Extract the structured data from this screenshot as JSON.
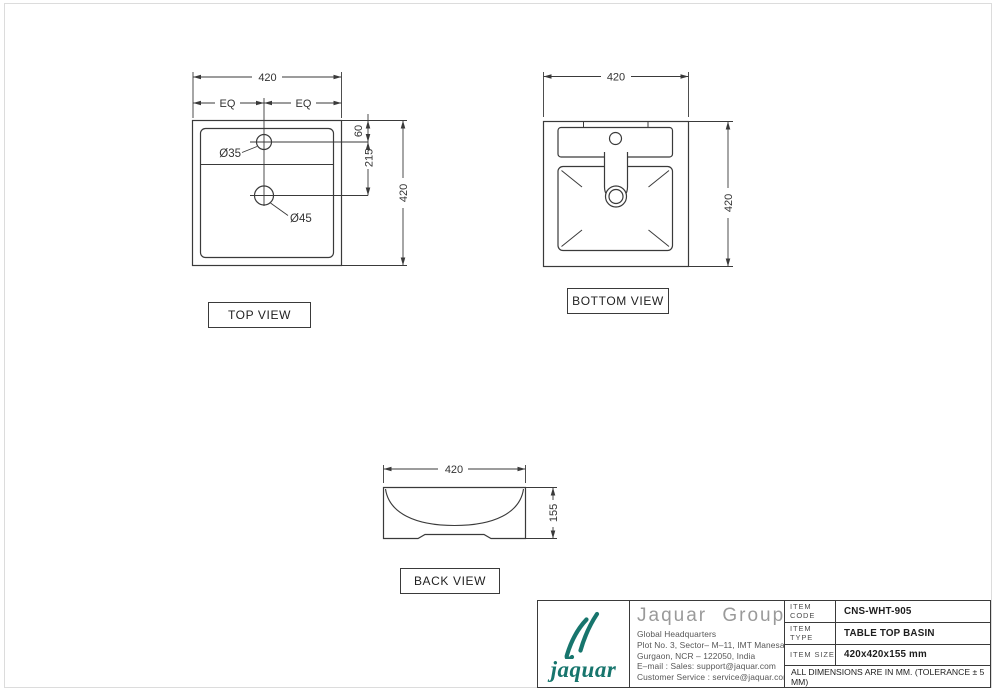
{
  "views": {
    "top": {
      "title": "TOP VIEW",
      "dim_width": "420",
      "dim_height": "420",
      "dim_eq_left": "EQ",
      "dim_eq_right": "EQ",
      "dim_faucet_offset": "60",
      "dim_drain_offset": "215",
      "faucet_hole_label": "Ø35",
      "drain_hole_label": "Ø45"
    },
    "bottom": {
      "title": "BOTTOM VIEW",
      "dim_width": "420",
      "dim_height": "420"
    },
    "back": {
      "title": "BACK VIEW",
      "dim_width": "420",
      "dim_height": "155"
    }
  },
  "title_block": {
    "logo_text": "jaquar",
    "brand_color": "#17756D",
    "company_name": "Jaquar Group",
    "address_lines": [
      "Global Headquarters",
      "Plot No. 3, Sector– M–11, IMT Manesar",
      "Gurgaon, NCR – 122050, India",
      "E–mail : Sales: support@jaquar.com",
      "Customer Service : service@jaquar.com"
    ],
    "items": [
      {
        "label": "ITEM CODE",
        "value": "CNS-WHT-905"
      },
      {
        "label": "ITEM TYPE",
        "value": "TABLE TOP BASIN"
      },
      {
        "label": "ITEM SIZE",
        "value": "420x420x155 mm"
      }
    ],
    "note": "ALL DIMENSIONS ARE IN MM. (TOLERANCE ± 5 MM)"
  }
}
